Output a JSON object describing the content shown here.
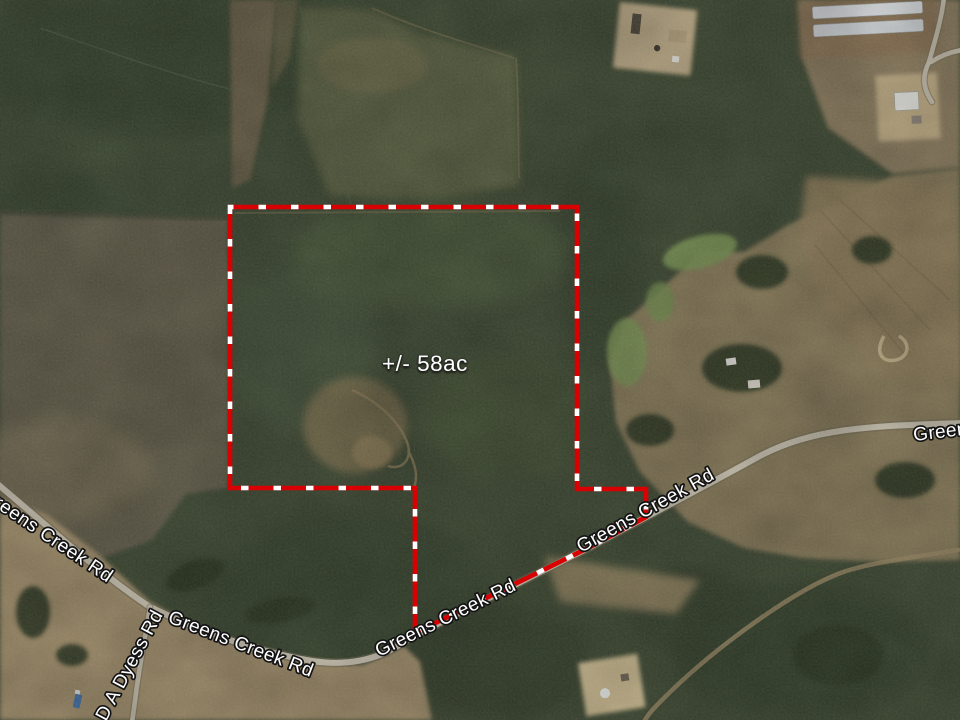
{
  "map": {
    "acreage_label": "+/- 58ac",
    "road_labels": [
      {
        "text": "Greens Creek Rd"
      },
      {
        "text": "D A Dyess Rd"
      },
      {
        "text": "Greens Creek Rd"
      },
      {
        "text": "Greens Creek Rd"
      },
      {
        "text": "Greens Creek Rd"
      },
      {
        "text": "Greens Creek Rd"
      }
    ],
    "boundary": {
      "color": "#d80000",
      "dash_color": "#ffffff",
      "points": "230,207 577,207 577,489 646,489 646,517 590,547 415,633 415,488 230,488"
    },
    "roads": {
      "greens_creek_d": "M -12 476 C 36 516 100 574 150 607 C 198 630 252 651 312 661 C 345 666 378 662 408 639 L 590 547 C 642 519 700 489 758 457 C 812 428 868 426 962 423",
      "dyess_d": "M 150 607 C 146 632 141 658 137 686 C 135 700 134 710 132 722",
      "north_lane_d": "M 944 -2 C 941 22 935 40 929 62 C 921 78 924 90 932 102 M 962 50 C 950 52 940 56 931 62",
      "dirt_track_d": "M 958 550 C 908 558 862 564 838 574 C 792 592 714 648 664 698 C 654 708 648 714 644 722"
    },
    "colors": {
      "road": "#ccc5b3",
      "label_text": "#ffffff",
      "label_outline": "#141414",
      "forest_base": "#3a462f"
    }
  }
}
